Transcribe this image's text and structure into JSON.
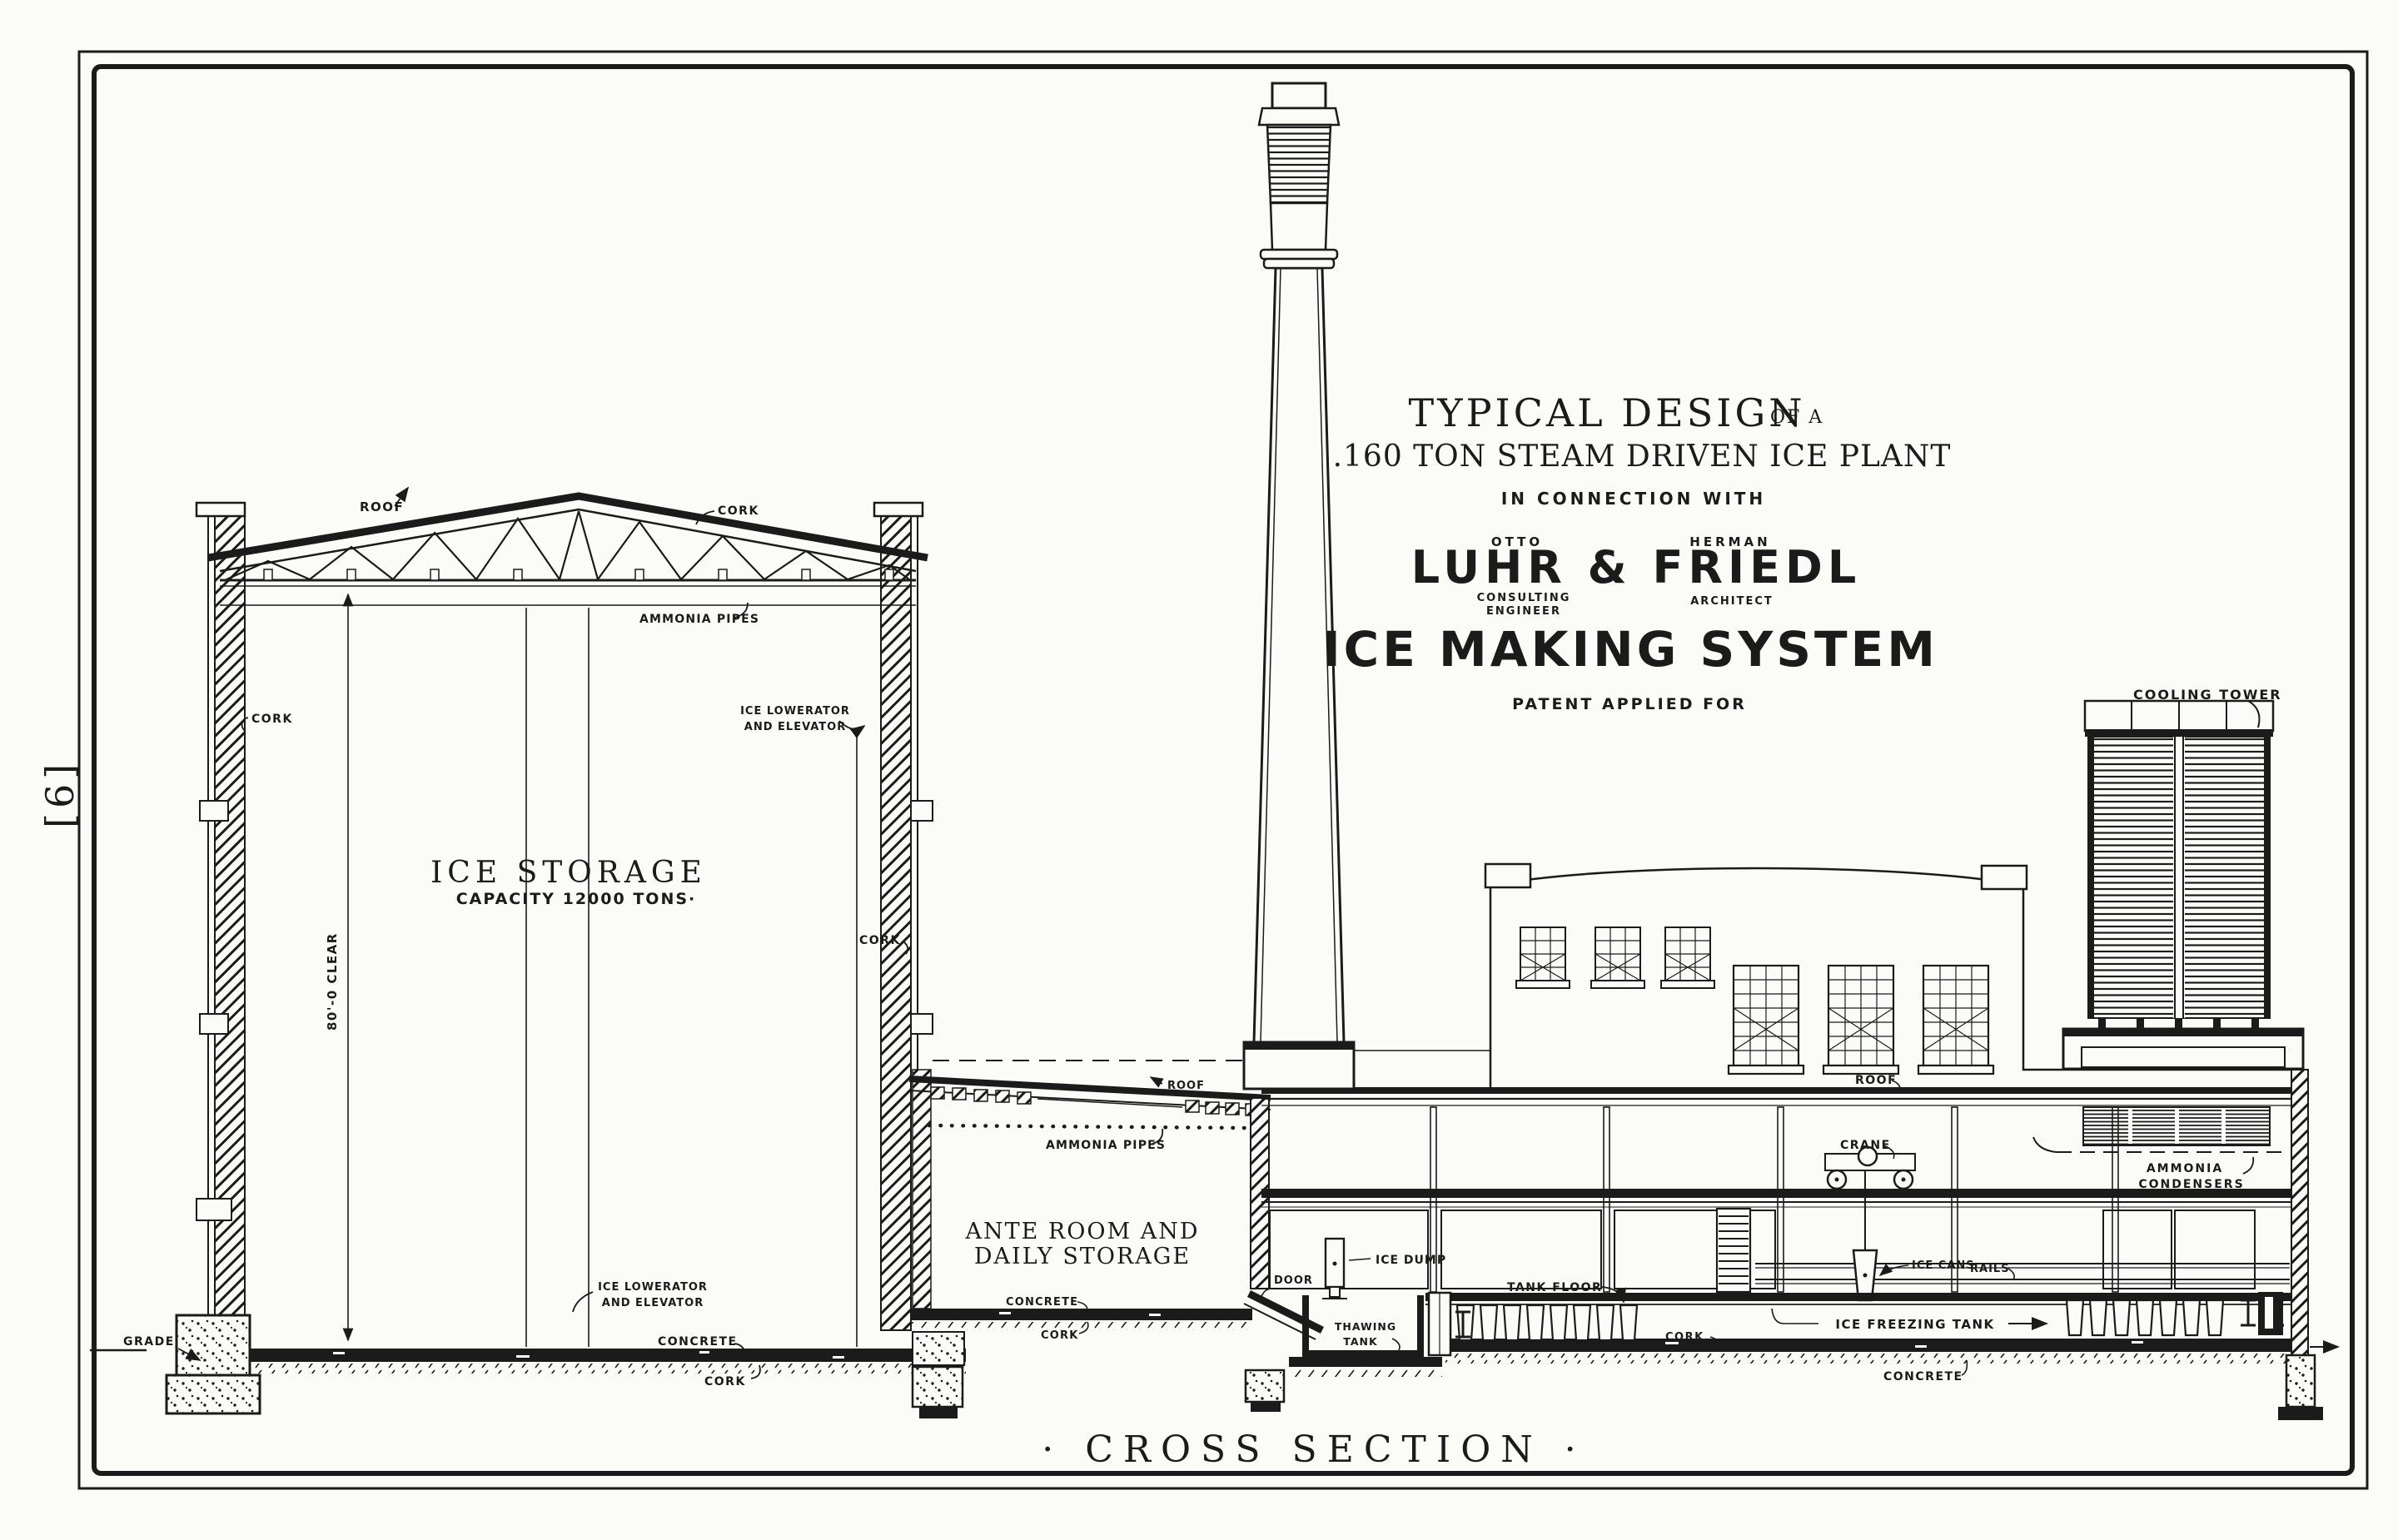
{
  "colors": {
    "ink": "#1b1b1b",
    "paper": "#fbfbf8"
  },
  "page_marginal": {
    "page_number": "[6]"
  },
  "title_block": {
    "line1": "TYPICAL DESIGN",
    "line1_small": "OF A",
    "line2": ".160 TON STEAM DRIVEN ICE PLANT",
    "connection": "IN CONNECTION WITH",
    "name_left": "OTTO",
    "name_right": "HERMAN",
    "firm_name": "LUHR & FRIEDL",
    "role_left_1": "CONSULTING",
    "role_left_2": "ENGINEER",
    "role_right": "ARCHITECT",
    "system_name": "ICE MAKING SYSTEM",
    "patent": "PATENT APPLIED FOR"
  },
  "footer": {
    "drawing_title": "· CROSS SECTION ·"
  },
  "ice_storage": {
    "room_name": "ICE STORAGE",
    "capacity": "CAPACITY 12000 TONS·",
    "roof": "ROOF",
    "cork_roof": "CORK",
    "ammonia_pipes": "AMMONIA PIPES",
    "cork_wall_left": "CORK",
    "cork_wall_right": "CORK",
    "lowerator_top_1": "ICE LOWERATOR",
    "lowerator_top_2": "AND ELEVATOR",
    "lowerator_bottom_1": "ICE LOWERATOR",
    "lowerator_bottom_2": "AND ELEVATOR",
    "clear_height": "80'-0 CLEAR",
    "grade": "GRADE",
    "concrete": "CONCRETE",
    "cork_floor": "CORK"
  },
  "ante_room": {
    "name_1": "ANTE ROOM AND",
    "name_2": "DAILY STORAGE",
    "roof": "ROOF",
    "ammonia_pipes": "AMMONIA PIPES",
    "door": "DOOR",
    "concrete": "CONCRETE",
    "cork": "CORK"
  },
  "machine_hall": {
    "roof": "ROOF",
    "crane": "CRANE",
    "ice_cans": "ICE CANS",
    "rails": "RAILS",
    "tank_floor": "TANK FLOOR",
    "ice_dump": "ICE DUMP",
    "thawing_1": "THAWING",
    "thawing_2": "TANK",
    "freezing_tank": "ICE FREEZING TANK",
    "cork": "CORK",
    "concrete": "CONCRETE",
    "condensers_1": "AMMONIA",
    "condensers_2": "CONDENSERS",
    "cooling_tower": "COOLING TOWER"
  }
}
